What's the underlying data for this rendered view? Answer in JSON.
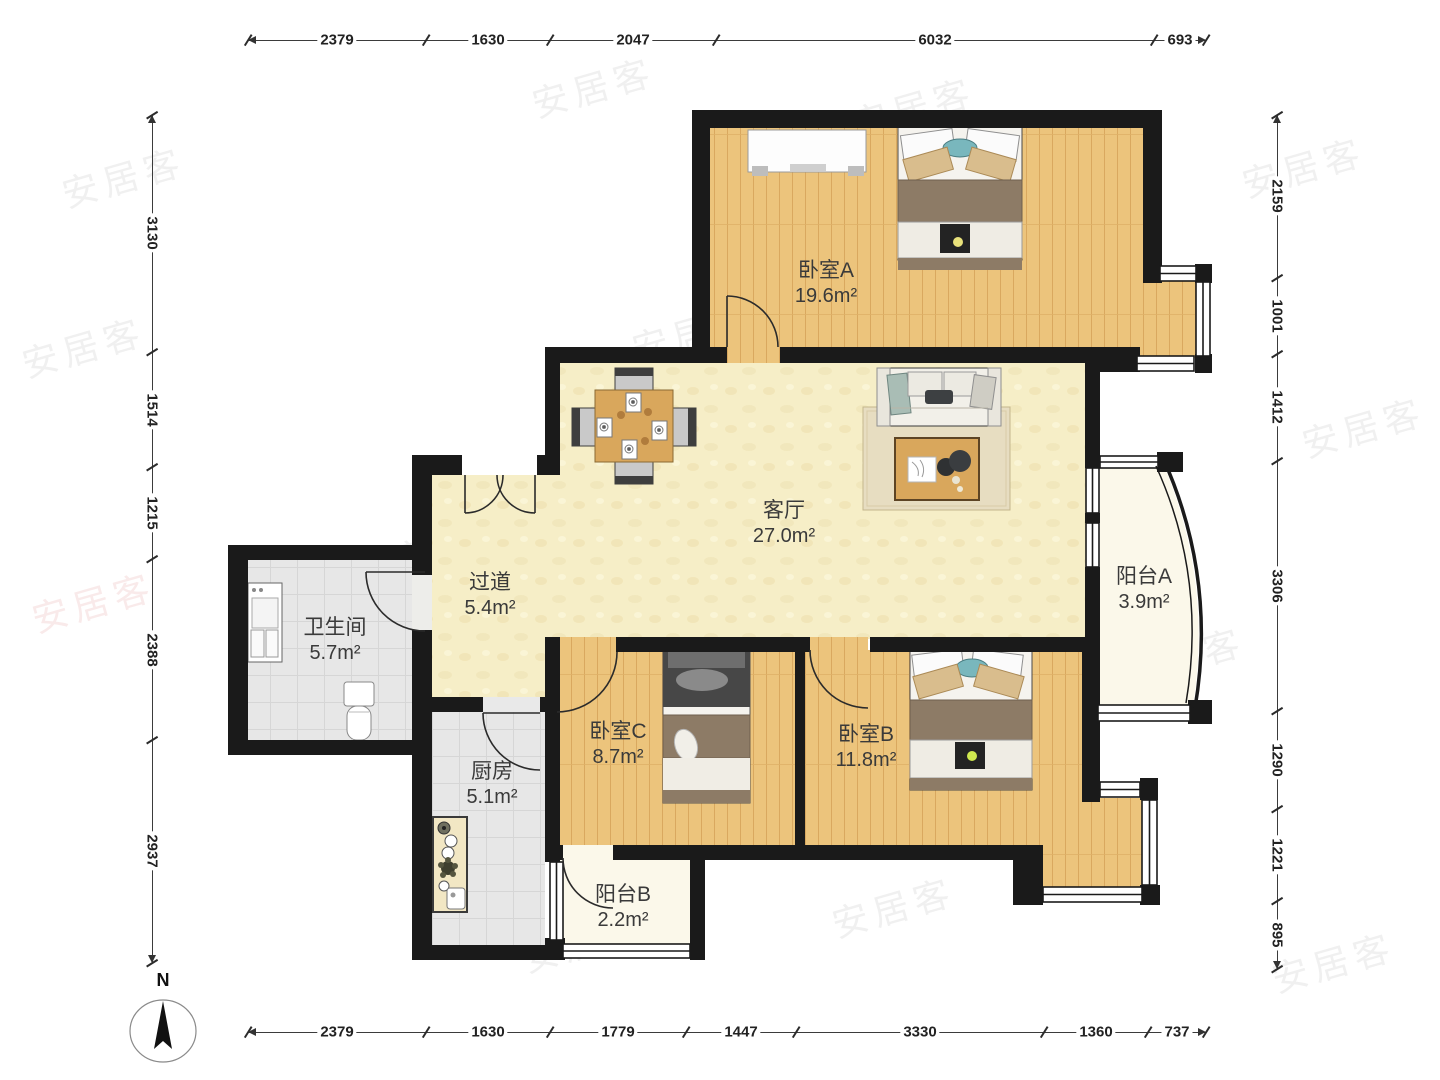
{
  "watermark": {
    "text": "安居客"
  },
  "compass": {
    "label": "N"
  },
  "rooms": {
    "bedroomA": {
      "name": "卧室A",
      "area": "19.6m²"
    },
    "livingRoom": {
      "name": "客厅",
      "area": "27.0m²"
    },
    "hallway": {
      "name": "过道",
      "area": "5.4m²"
    },
    "bathroom": {
      "name": "卫生间",
      "area": "5.7m²"
    },
    "kitchen": {
      "name": "厨房",
      "area": "5.1m²"
    },
    "bedroomC": {
      "name": "卧室C",
      "area": "8.7m²"
    },
    "bedroomB": {
      "name": "卧室B",
      "area": "11.8m²"
    },
    "balconyA": {
      "name": "阳台A",
      "area": "3.9m²"
    },
    "balconyB": {
      "name": "阳台B",
      "area": "2.2m²"
    }
  },
  "dimensions": {
    "top": [
      "2379",
      "1630",
      "2047",
      "6032",
      "693"
    ],
    "bottom": [
      "2379",
      "1630",
      "1779",
      "1447",
      "3330",
      "1360",
      "737"
    ],
    "left": [
      "3130",
      "1514",
      "1215",
      "2388",
      "2937"
    ],
    "right": [
      "2159",
      "1001",
      "1412",
      "3306",
      "1290",
      "1221",
      "895"
    ]
  },
  "colors": {
    "wall": "#1a1a1a",
    "wood_floor": "#ecc47c",
    "living_floor": "#f6eec7",
    "tile_floor": "#e7e7e7",
    "balcony_floor": "#fbf8ea",
    "duvet_brown": "#8d7b66",
    "pillow_tan": "#d9bd8d",
    "accent_teal": "#79b7bd",
    "table_wood": "#d9a75c"
  }
}
